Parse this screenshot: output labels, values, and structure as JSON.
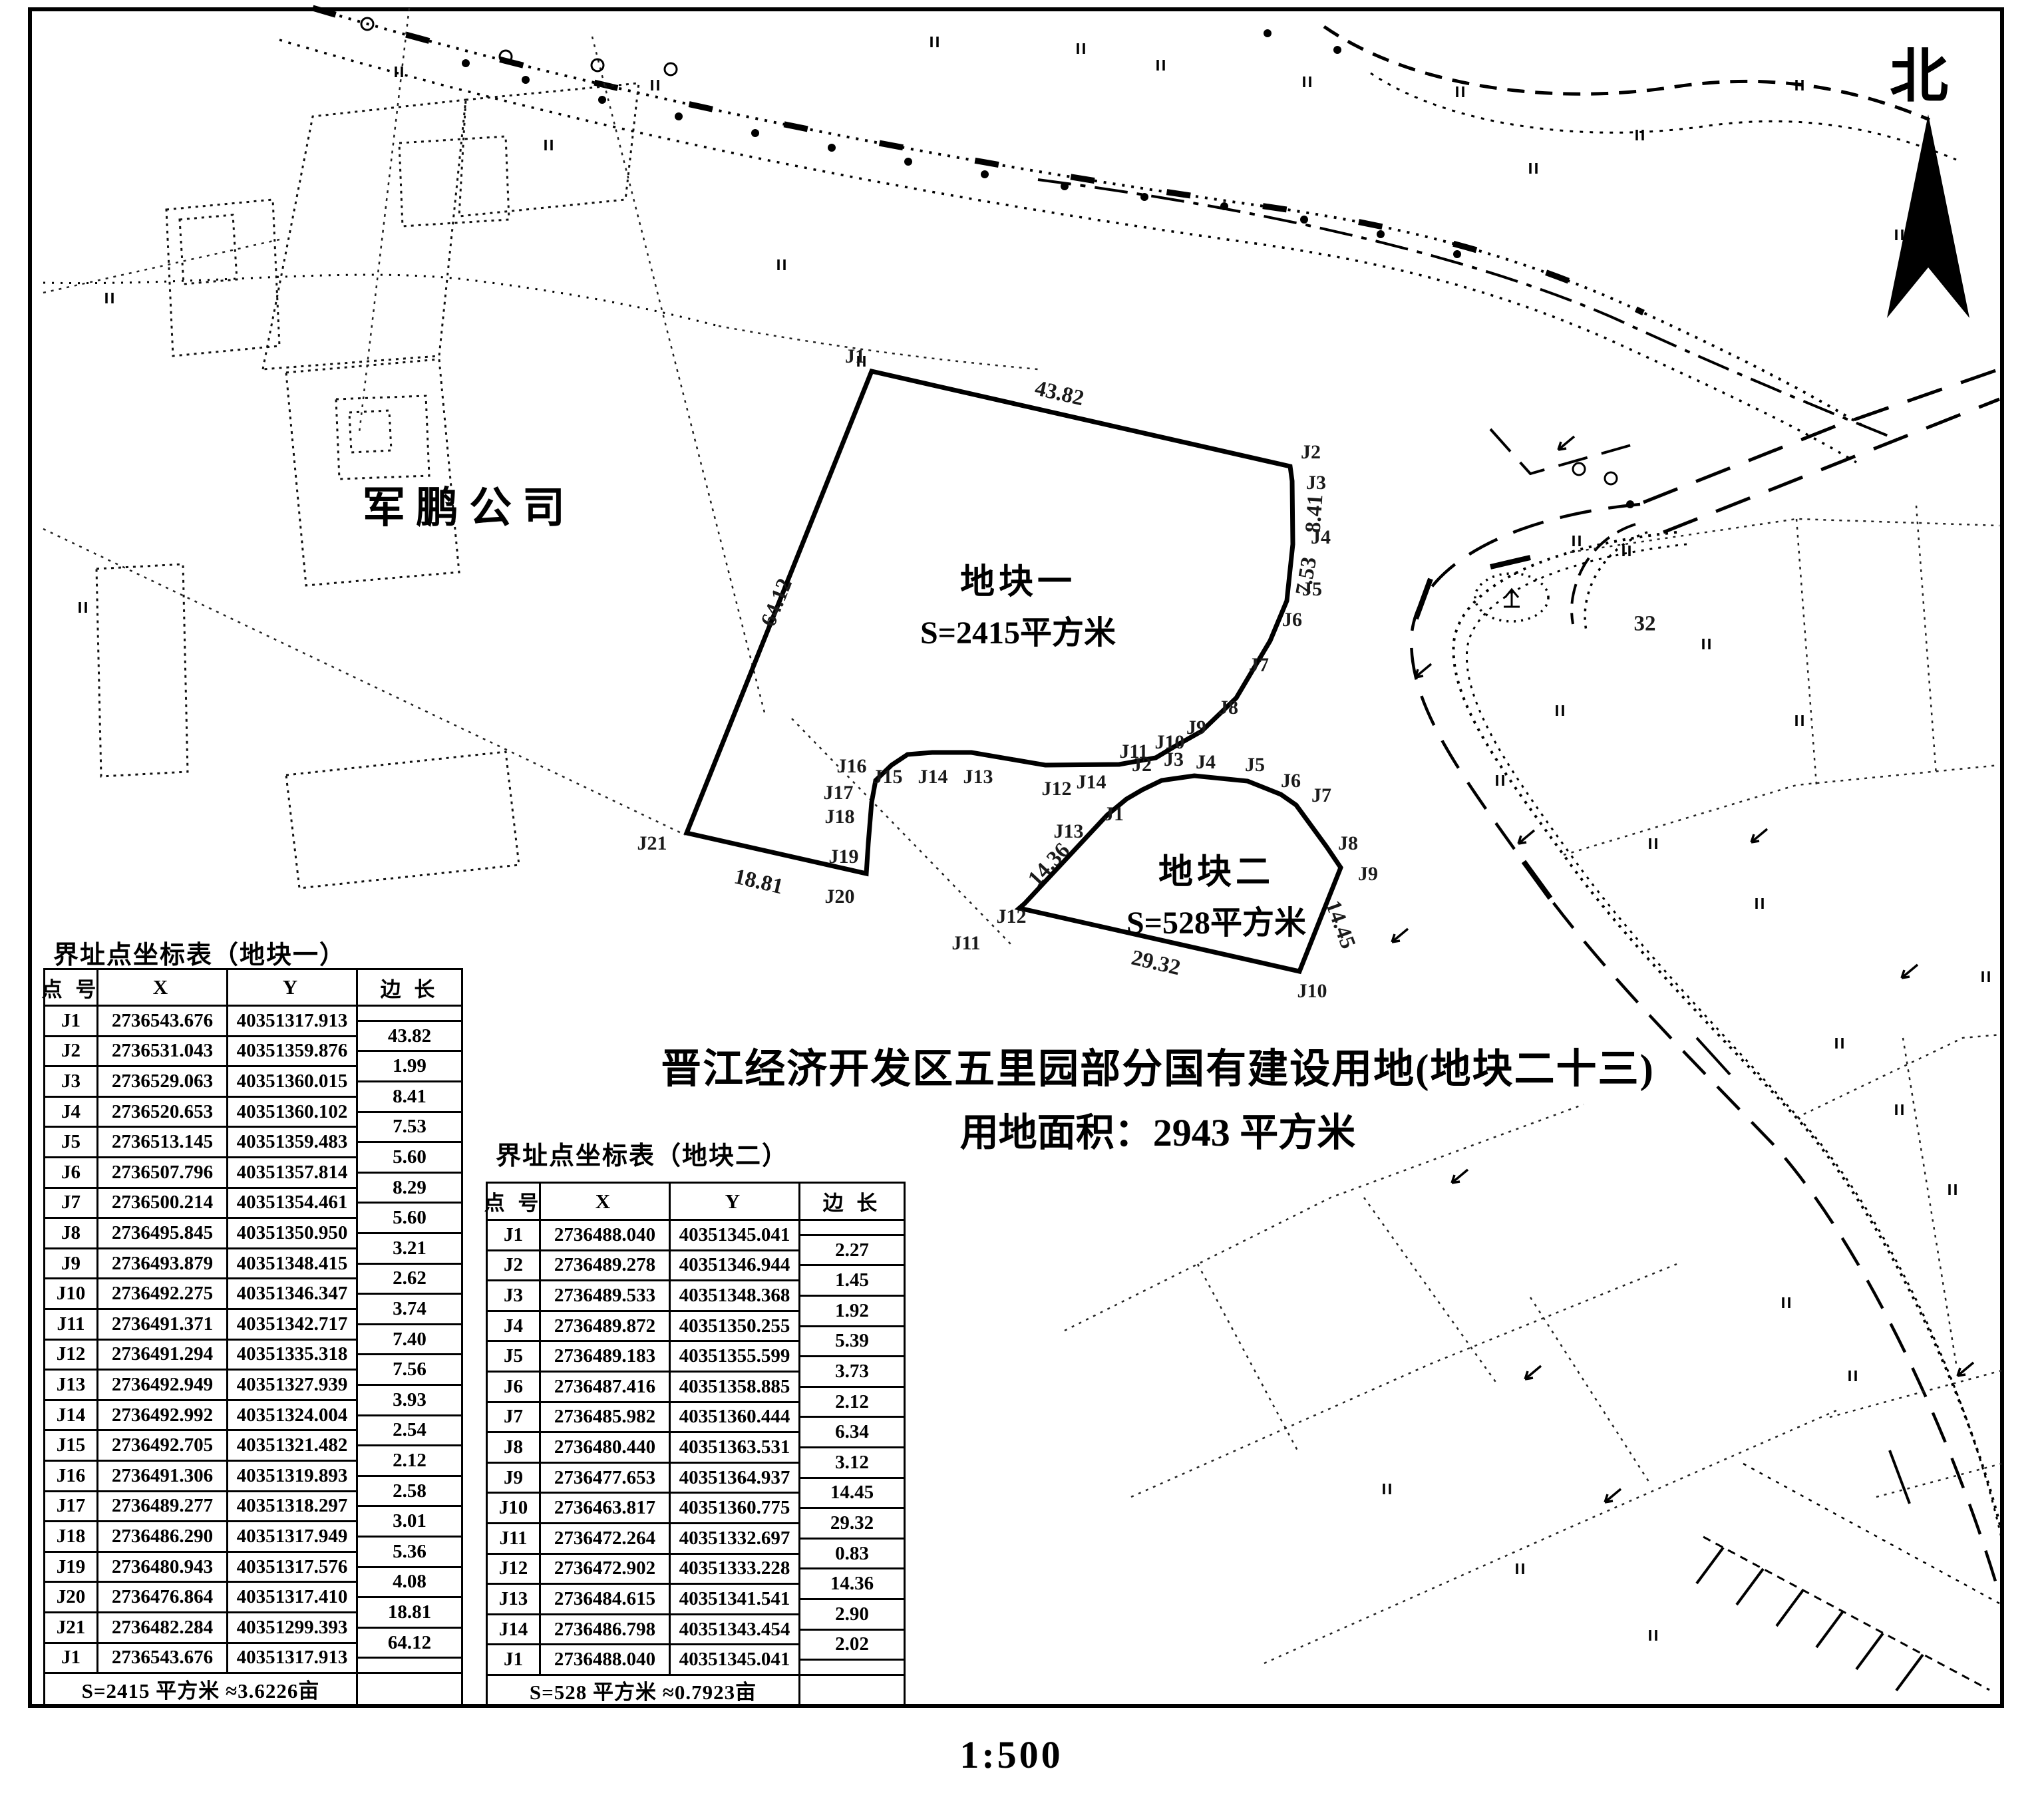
{
  "compass": {
    "label": "北"
  },
  "scale_label": "1:500",
  "company_label": "军鹏公司",
  "title": {
    "line1": "晋江经济开发区五里园部分国有建设用地(地块二十三)",
    "line2": "用地面积：2943 平方米"
  },
  "parcels": [
    {
      "map_name": "地块一",
      "map_area": "S=2415平方米",
      "table_title": "界址点坐标表（地块一）",
      "headers": [
        "点 号",
        "X",
        "Y",
        "边 长"
      ],
      "points": [
        [
          "J1",
          "2736543.676",
          "40351317.913"
        ],
        [
          "J2",
          "2736531.043",
          "40351359.876"
        ],
        [
          "J3",
          "2736529.063",
          "40351360.015"
        ],
        [
          "J4",
          "2736520.653",
          "40351360.102"
        ],
        [
          "J5",
          "2736513.145",
          "40351359.483"
        ],
        [
          "J6",
          "2736507.796",
          "40351357.814"
        ],
        [
          "J7",
          "2736500.214",
          "40351354.461"
        ],
        [
          "J8",
          "2736495.845",
          "40351350.950"
        ],
        [
          "J9",
          "2736493.879",
          "40351348.415"
        ],
        [
          "J10",
          "2736492.275",
          "40351346.347"
        ],
        [
          "J11",
          "2736491.371",
          "40351342.717"
        ],
        [
          "J12",
          "2736491.294",
          "40351335.318"
        ],
        [
          "J13",
          "2736492.949",
          "40351327.939"
        ],
        [
          "J14",
          "2736492.992",
          "40351324.004"
        ],
        [
          "J15",
          "2736492.705",
          "40351321.482"
        ],
        [
          "J16",
          "2736491.306",
          "40351319.893"
        ],
        [
          "J17",
          "2736489.277",
          "40351318.297"
        ],
        [
          "J18",
          "2736486.290",
          "40351317.949"
        ],
        [
          "J19",
          "2736480.943",
          "40351317.576"
        ],
        [
          "J20",
          "2736476.864",
          "40351317.410"
        ],
        [
          "J21",
          "2736482.284",
          "40351299.393"
        ],
        [
          "J1",
          "2736543.676",
          "40351317.913"
        ]
      ],
      "lengths": [
        "43.82",
        "1.99",
        "8.41",
        "7.53",
        "5.60",
        "8.29",
        "5.60",
        "3.21",
        "2.62",
        "3.74",
        "7.40",
        "7.56",
        "3.93",
        "2.54",
        "2.12",
        "2.58",
        "3.01",
        "5.36",
        "4.08",
        "18.81",
        "64.12"
      ],
      "footer": "S=2415 平方米 ≈3.6226亩"
    },
    {
      "map_name": "地块二",
      "map_area": "S=528平方米",
      "table_title": "界址点坐标表（地块二）",
      "headers": [
        "点 号",
        "X",
        "Y",
        "边 长"
      ],
      "points": [
        [
          "J1",
          "2736488.040",
          "40351345.041"
        ],
        [
          "J2",
          "2736489.278",
          "40351346.944"
        ],
        [
          "J3",
          "2736489.533",
          "40351348.368"
        ],
        [
          "J4",
          "2736489.872",
          "40351350.255"
        ],
        [
          "J5",
          "2736489.183",
          "40351355.599"
        ],
        [
          "J6",
          "2736487.416",
          "40351358.885"
        ],
        [
          "J7",
          "2736485.982",
          "40351360.444"
        ],
        [
          "J8",
          "2736480.440",
          "40351363.531"
        ],
        [
          "J9",
          "2736477.653",
          "40351364.937"
        ],
        [
          "J10",
          "2736463.817",
          "40351360.775"
        ],
        [
          "J11",
          "2736472.264",
          "40351332.697"
        ],
        [
          "J12",
          "2736472.902",
          "40351333.228"
        ],
        [
          "J13",
          "2736484.615",
          "40351341.541"
        ],
        [
          "J14",
          "2736486.798",
          "40351343.454"
        ],
        [
          "J1",
          "2736488.040",
          "40351345.041"
        ]
      ],
      "lengths": [
        "2.27",
        "1.45",
        "1.92",
        "5.39",
        "3.73",
        "2.12",
        "6.34",
        "3.12",
        "14.45",
        "29.32",
        "0.83",
        "14.36",
        "2.90",
        "2.02"
      ],
      "footer": "S=528 平方米 ≈0.7923亩"
    }
  ],
  "map_labels": {
    "p1_vertices": [
      [
        "J1",
        1285,
        536
      ],
      [
        "J2",
        1970,
        680
      ],
      [
        "J3",
        1978,
        726
      ],
      [
        "J4",
        1985,
        808
      ],
      [
        "J5",
        1972,
        886
      ],
      [
        "J6",
        1942,
        932
      ],
      [
        "J7",
        1892,
        1000
      ],
      [
        "J8",
        1846,
        1064
      ],
      [
        "J9",
        1798,
        1094
      ],
      [
        "J10",
        1758,
        1116
      ],
      [
        "J11",
        1704,
        1130
      ],
      [
        "J12",
        1588,
        1186
      ],
      [
        "J13",
        1470,
        1168
      ],
      [
        "J14",
        1402,
        1168
      ],
      [
        "J15",
        1334,
        1168
      ],
      [
        "J16",
        1280,
        1152
      ],
      [
        "J17",
        1260,
        1192
      ],
      [
        "J18",
        1262,
        1228
      ],
      [
        "J19",
        1268,
        1288
      ],
      [
        "J20",
        1262,
        1348
      ],
      [
        "J21",
        980,
        1268
      ]
    ],
    "p2_vertices": [
      [
        "J1",
        1674,
        1224
      ],
      [
        "J2",
        1716,
        1150
      ],
      [
        "J3",
        1764,
        1142
      ],
      [
        "J4",
        1812,
        1146
      ],
      [
        "J5",
        1886,
        1150
      ],
      [
        "J6",
        1940,
        1174
      ],
      [
        "J7",
        1986,
        1196
      ],
      [
        "J8",
        2026,
        1268
      ],
      [
        "J9",
        2056,
        1314
      ],
      [
        "J10",
        1972,
        1490
      ],
      [
        "J11",
        1452,
        1418
      ],
      [
        "J12",
        1520,
        1378
      ],
      [
        "J13",
        1606,
        1250
      ],
      [
        "J14",
        1640,
        1176
      ]
    ],
    "edges": [
      [
        "43.82",
        1592,
        592,
        13
      ],
      [
        "64.12",
        1168,
        906,
        -68
      ],
      [
        "18.81",
        1140,
        1326,
        13
      ],
      [
        "8.41",
        1976,
        772,
        -86
      ],
      [
        "7.53",
        1964,
        866,
        -80
      ],
      [
        "14.36",
        1577,
        1300,
        -47
      ],
      [
        "14.45",
        2014,
        1390,
        70
      ],
      [
        "29.32",
        1737,
        1448,
        13
      ],
      [
        "32",
        2472,
        938,
        0
      ]
    ]
  }
}
